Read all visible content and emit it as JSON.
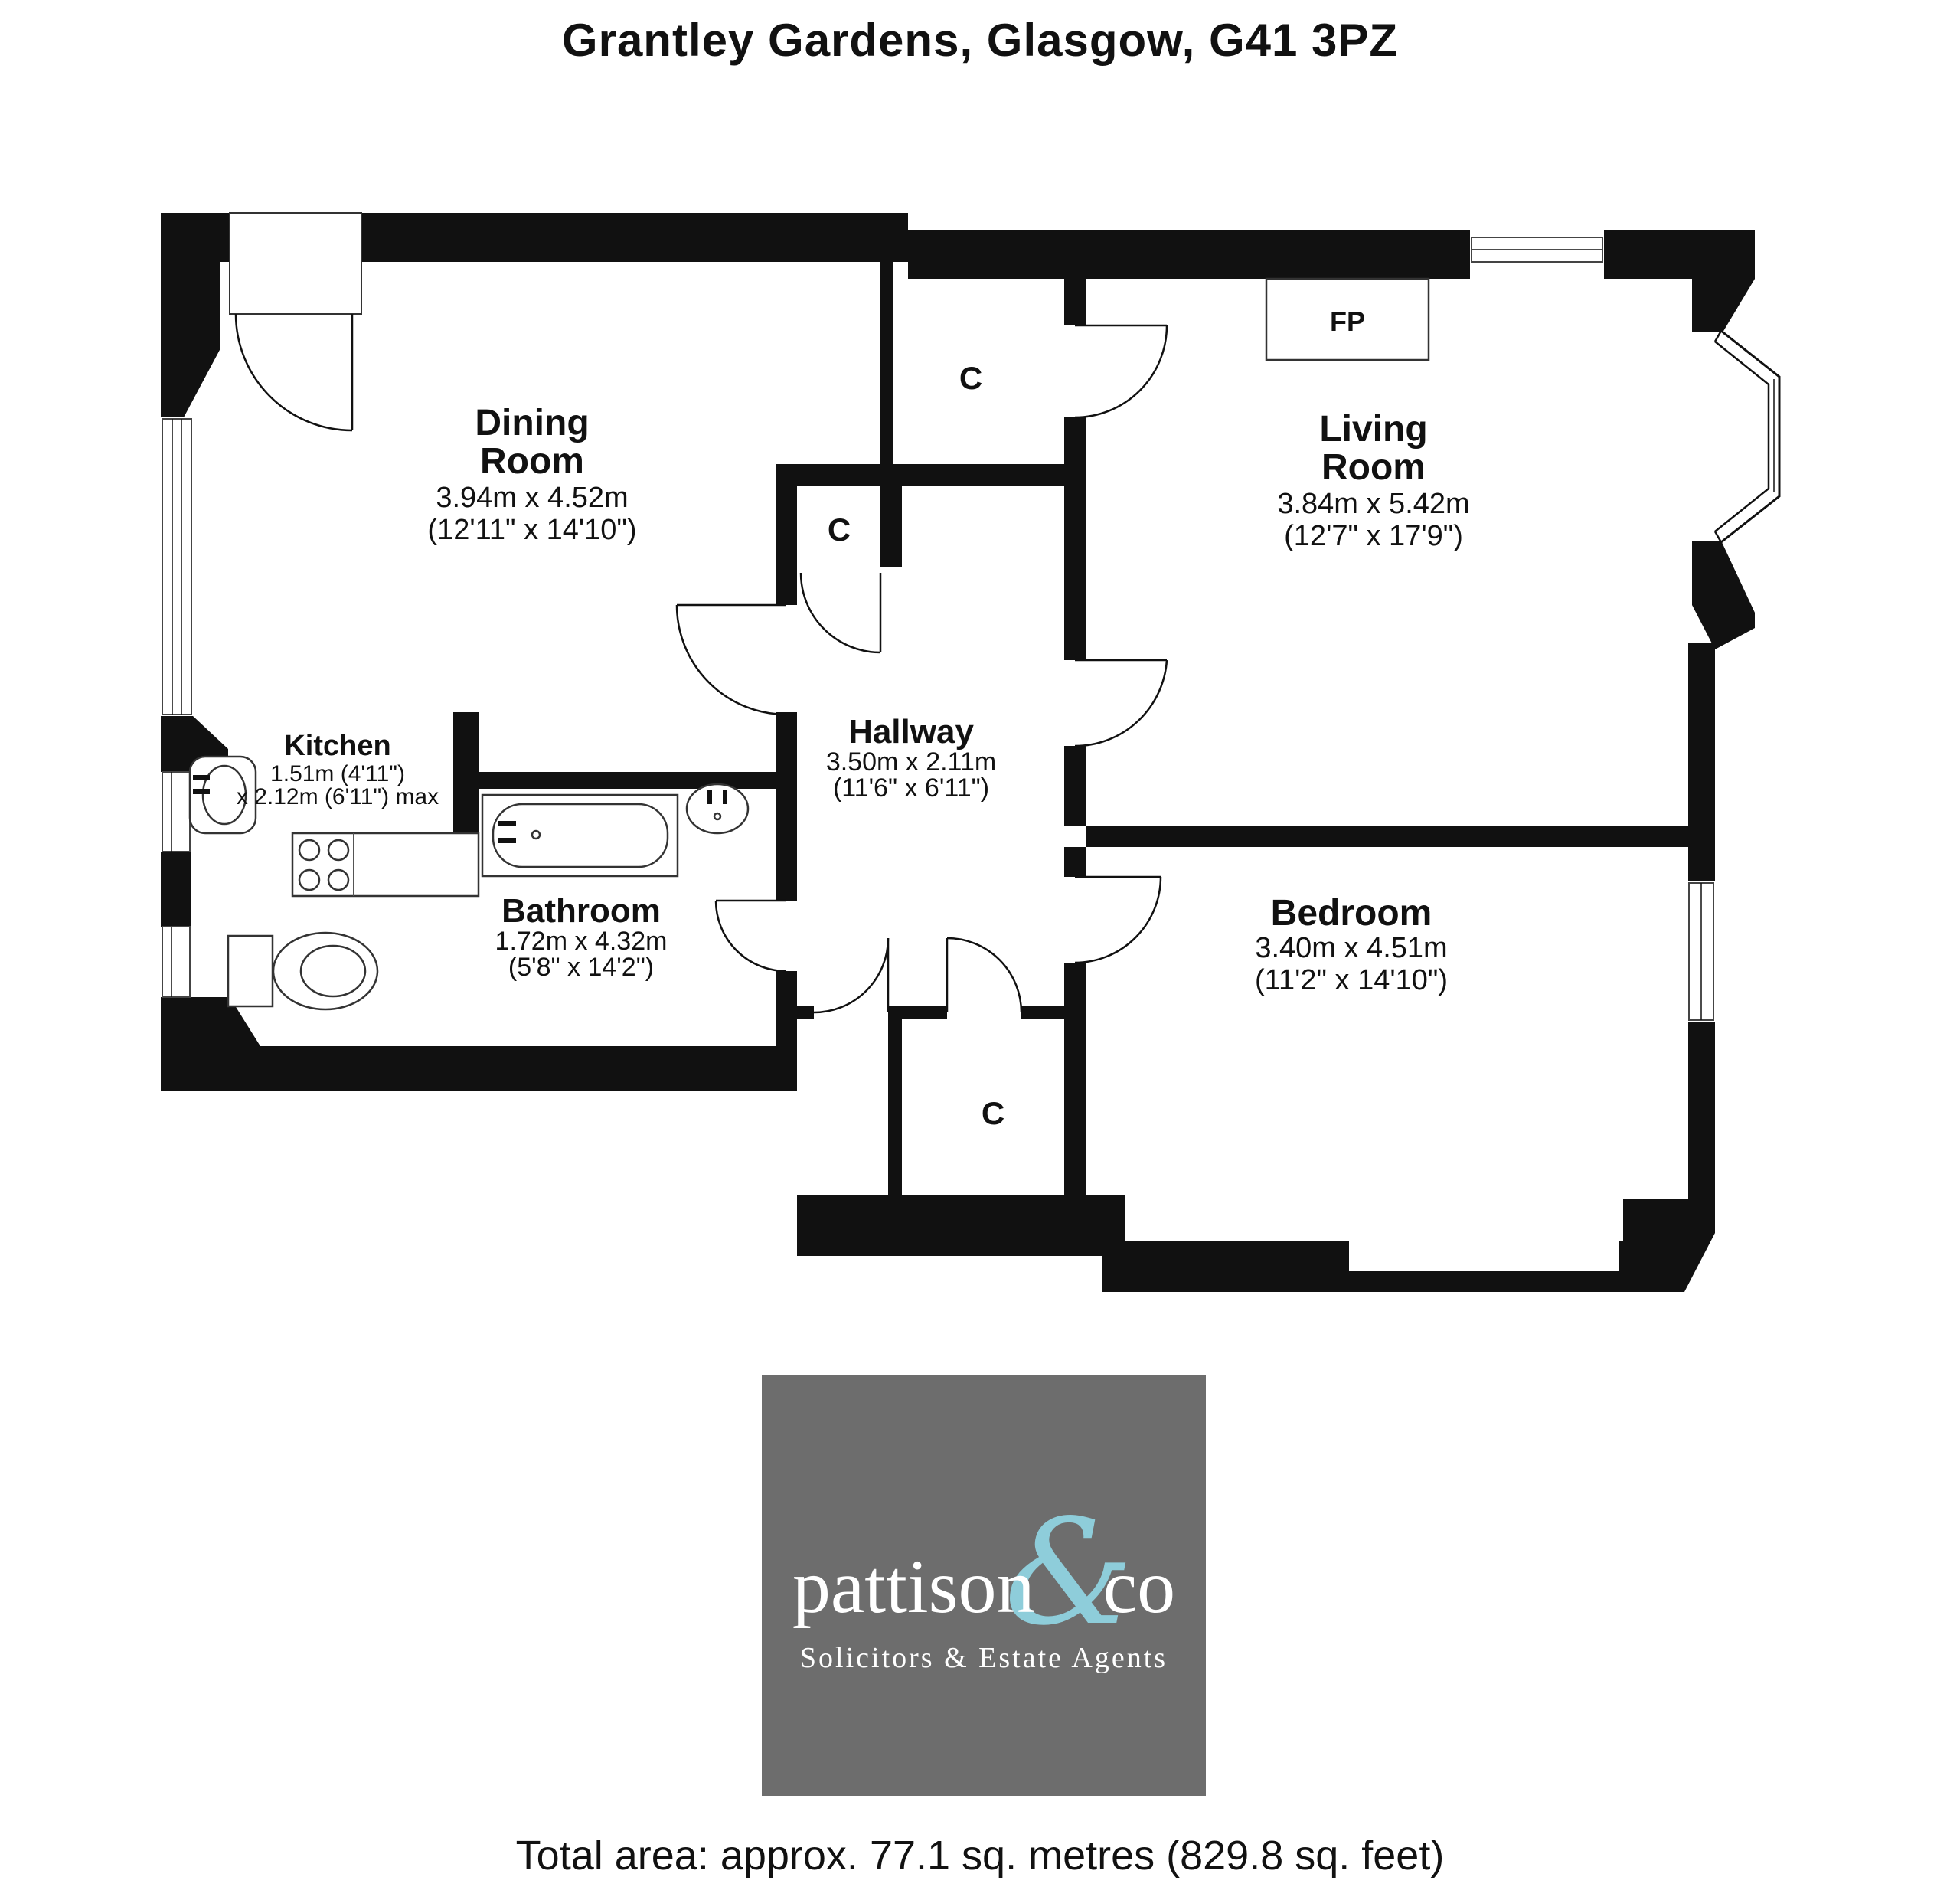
{
  "title": "Grantley Gardens, Glasgow, G41 3PZ",
  "rooms": {
    "dining": {
      "line1": "Dining",
      "line2": "Room",
      "metric": "3.94m x 4.52m",
      "imperial": "(12'11\" x 14'10\")"
    },
    "living": {
      "line1": "Living",
      "line2": "Room",
      "metric": "3.84m x 5.42m",
      "imperial": "(12'7\" x 17'9\")"
    },
    "kitchen": {
      "line1": "Kitchen",
      "metric": "1.51m (4'11\")",
      "metric2": "x 2.12m (6'11\") max"
    },
    "hallway": {
      "line1": "Hallway",
      "metric": "3.50m x 2.11m",
      "imperial": "(11'6\" x 6'11\")"
    },
    "bathroom": {
      "line1": "Bathroom",
      "metric": "1.72m x 4.32m",
      "imperial": "(5'8\" x 14'2\")"
    },
    "bedroom": {
      "line1": "Bedroom",
      "metric": "3.40m x 4.51m",
      "imperial": "(11'2\" x 14'10\")"
    }
  },
  "markers": {
    "closet": "C",
    "fireplace": "FP"
  },
  "logo": {
    "brand_main": "pattison",
    "brand_amp": "&",
    "brand_suffix": "co",
    "tagline": "Solicitors & Estate Agents",
    "bg_color": "#6d6d6d",
    "amp_color": "#8ecdda",
    "text_color": "#ffffff"
  },
  "footer": {
    "total_area": "Total area: approx. 77.1 sq. metres (829.8 sq. feet)"
  },
  "plan_colors": {
    "walls": "#111111",
    "background": "#ffffff"
  }
}
